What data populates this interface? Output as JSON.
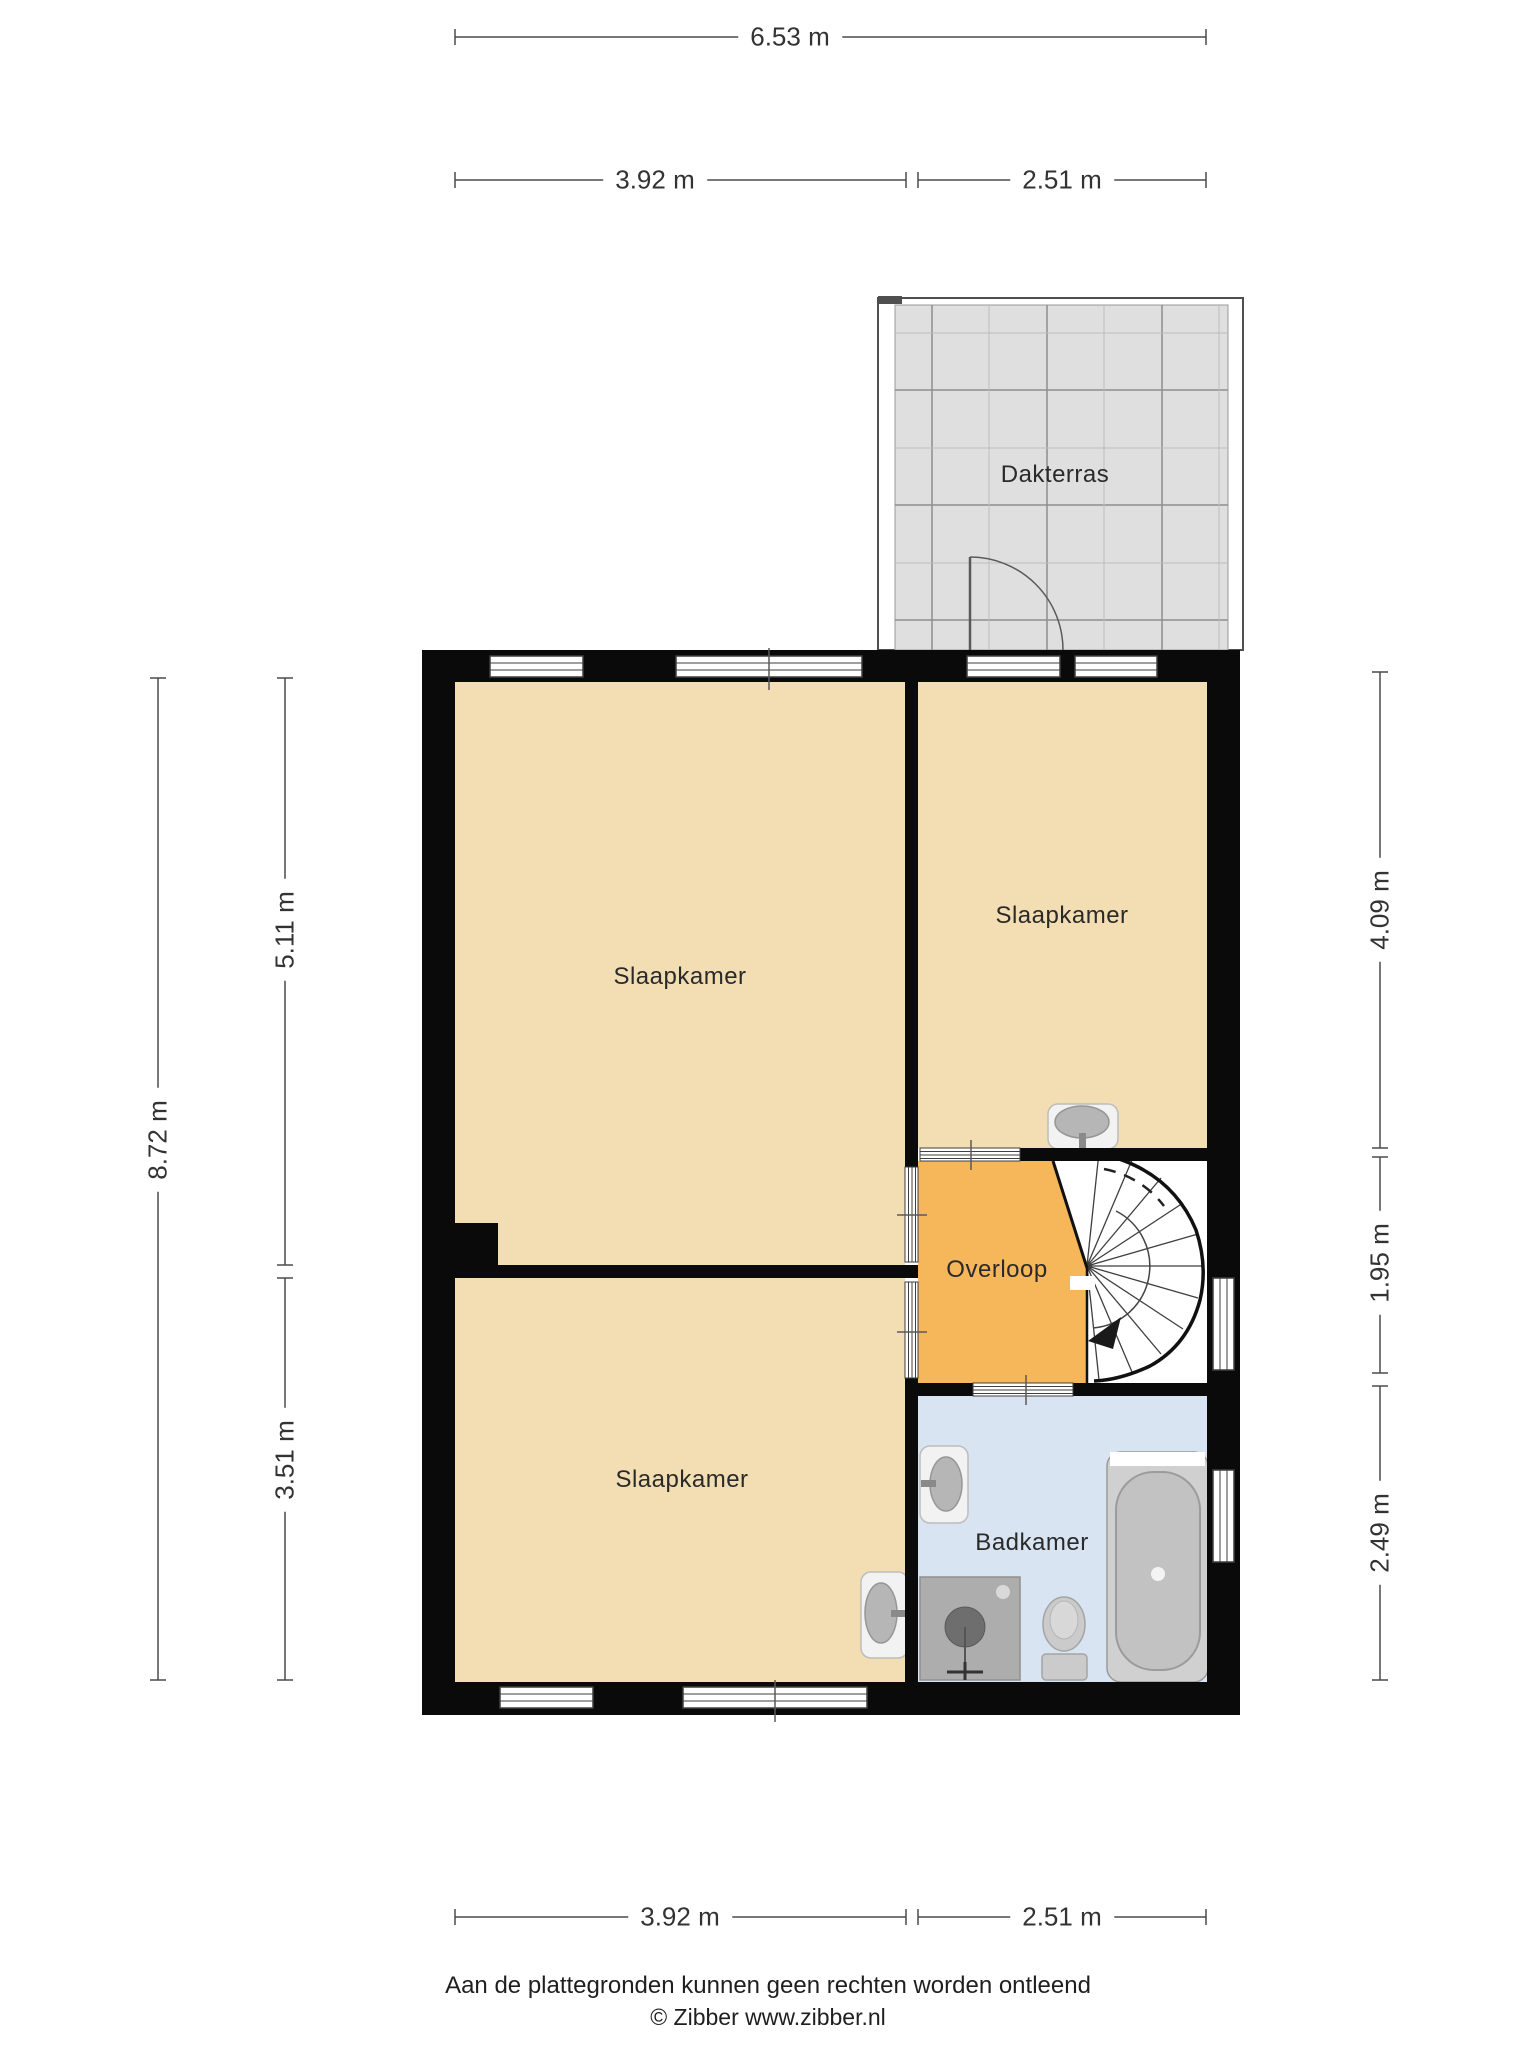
{
  "rooms": {
    "dakterras": {
      "label": "Dakterras"
    },
    "slaapkamer1": {
      "label": "Slaapkamer"
    },
    "slaapkamer2": {
      "label": "Slaapkamer"
    },
    "slaapkamer3": {
      "label": "Slaapkamer"
    },
    "overloop": {
      "label": "Overloop"
    },
    "badkamer": {
      "label": "Badkamer"
    }
  },
  "dims": {
    "top_total": "6.53 m",
    "top_left": "3.92 m",
    "top_right": "2.51 m",
    "bottom_left": "3.92 m",
    "bottom_right": "2.51 m",
    "left_total": "8.72 m",
    "left_upper": "5.11 m",
    "left_lower": "3.51 m",
    "right_upper": "4.09 m",
    "right_middle": "1.95 m",
    "right_lower": "2.49 m"
  },
  "colors": {
    "wall": "#0a0a0a",
    "bedroom": "#F3DDB3",
    "landing": "#F6B65A",
    "bathroom": "#D8E4F1",
    "terrace_tile": "#DFDFDF"
  },
  "footer": {
    "disclaimer": "Aan de plattegronden kunnen geen rechten worden ontleend",
    "credit": "© Zibber www.zibber.nl"
  }
}
